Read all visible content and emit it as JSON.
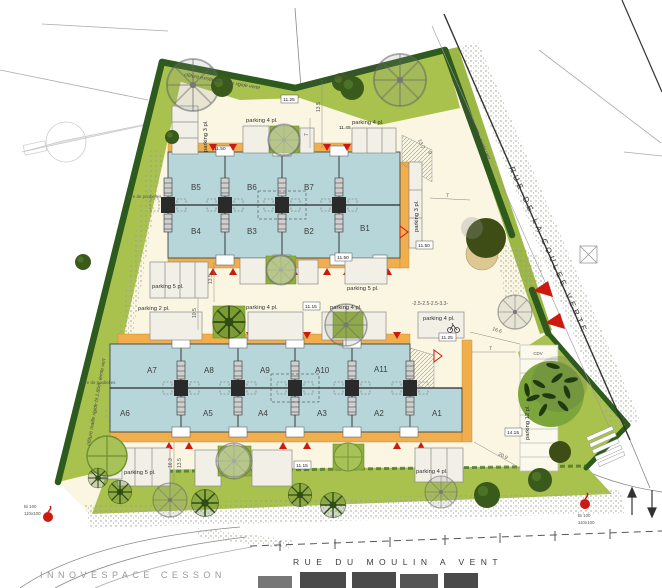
{
  "streets": {
    "coulee_verte": "RUE DE LA COULEE VERTE",
    "moulin_a_vent": "RUE DU MOULIN A VENT",
    "innovespace": "INNOVESPACE CESSON"
  },
  "fences": {
    "existing_top_left": "clôture existante maille rigide verte",
    "existing_top_right": "clôture existante maille rigide verte",
    "street_side": "clôture maille rigide ht 1.80m teinte vert",
    "west_side": "clôture maille rigide ht 1.80m, teinte vert"
  },
  "units": {
    "b": [
      "B5",
      "B6",
      "B7",
      "B4",
      "B3",
      "B2",
      "B1"
    ],
    "a_top": [
      "A7",
      "A8",
      "A9",
      "A10",
      "A11"
    ],
    "a_bottom": [
      "A6",
      "A5",
      "A4",
      "A3",
      "A2",
      "A1"
    ]
  },
  "parking_labels": [
    "parking 3 pl.",
    "parking 4 pl.",
    "parking 4 pl.",
    "parking 3 pl.",
    "parking 5 pl.",
    "parking 5 pl.",
    "parking 2 pl.",
    "parking 4 pl.",
    "parking 4 pl.",
    "parking 4 pl.",
    "parking 5 pl.",
    "parking 4 pl.",
    "parking 12 pl."
  ],
  "levels": [
    "11.25",
    "11.50",
    "11.45",
    "11.50",
    "11.50",
    "11.15",
    "11.25",
    "11.15",
    "14.15"
  ],
  "dims": {
    "d13_5_top": "13.5",
    "d7_top": "7",
    "d13_7": "13.7",
    "d9": "9",
    "d7_b1": "7",
    "d13_5_mid": "13.5",
    "d10_5": "10.5",
    "d16_3": "16.3",
    "d13_5_bottom": "13.5",
    "d16_6": "16.6",
    "d7_right": "7",
    "d20_9": "20.9",
    "d_spacing": "-2.5-2.5-2.5-3.3-"
  },
  "annotations": {
    "cdv": "CDV",
    "bike_box_line1": "PR",
    "bike_box_line2": "2 vl",
    "waste_area": "aire de poubelles",
    "hydrant_line1": "Bi 100",
    "hydrant_line2": "110x100"
  },
  "colors": {
    "site_fill": "#faf6e2",
    "lawn": "#a8c24d",
    "hedge": "#2d5a1d",
    "building": "#b7d6d9",
    "terrace": "#f0ae4c",
    "accent_red": "#cc1a10"
  }
}
